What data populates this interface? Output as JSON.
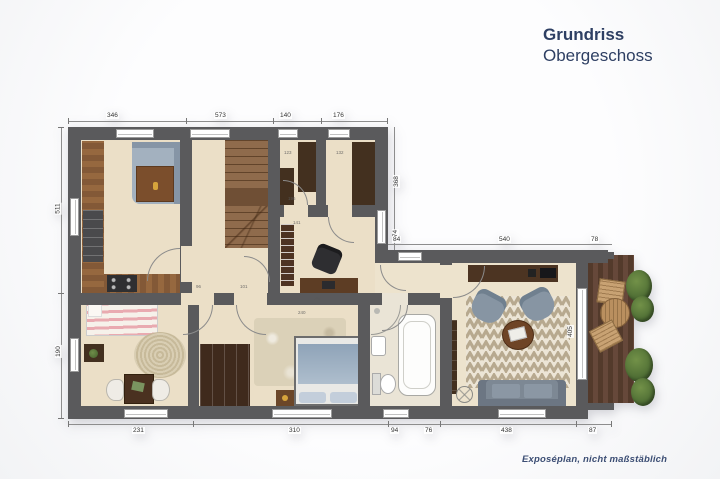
{
  "header": {
    "title": "Grundriss",
    "subtitle": "Obergeschoss"
  },
  "footer": {
    "note": "Exposéplan, nicht maßstäblich"
  },
  "colors": {
    "accent_navy": "#2e3f63",
    "wall": "#5a5a5c",
    "floor": "#ebdfc7",
    "dark_wood": "#43301f",
    "deck_wood": "#5e4030",
    "plant_green": "#5f7c40",
    "sofa_gray": "#7d8894",
    "textile_blue": "#9db0c4",
    "rug_cream": "#ece5d6",
    "rug_taupe": "#b7a98f"
  },
  "dimensions": {
    "top": [
      "346",
      "573",
      "140",
      "176"
    ],
    "left": [
      "511",
      "190"
    ],
    "right": [
      "368",
      "74"
    ],
    "wing_top": [
      "84",
      "540",
      "78"
    ],
    "bottom": [
      "231",
      "310",
      "94",
      "76",
      "438",
      "87"
    ],
    "living_right": [
      "405"
    ],
    "interior": [
      "123",
      "132",
      "196",
      "141",
      "96",
      "101",
      "296",
      "240"
    ]
  }
}
